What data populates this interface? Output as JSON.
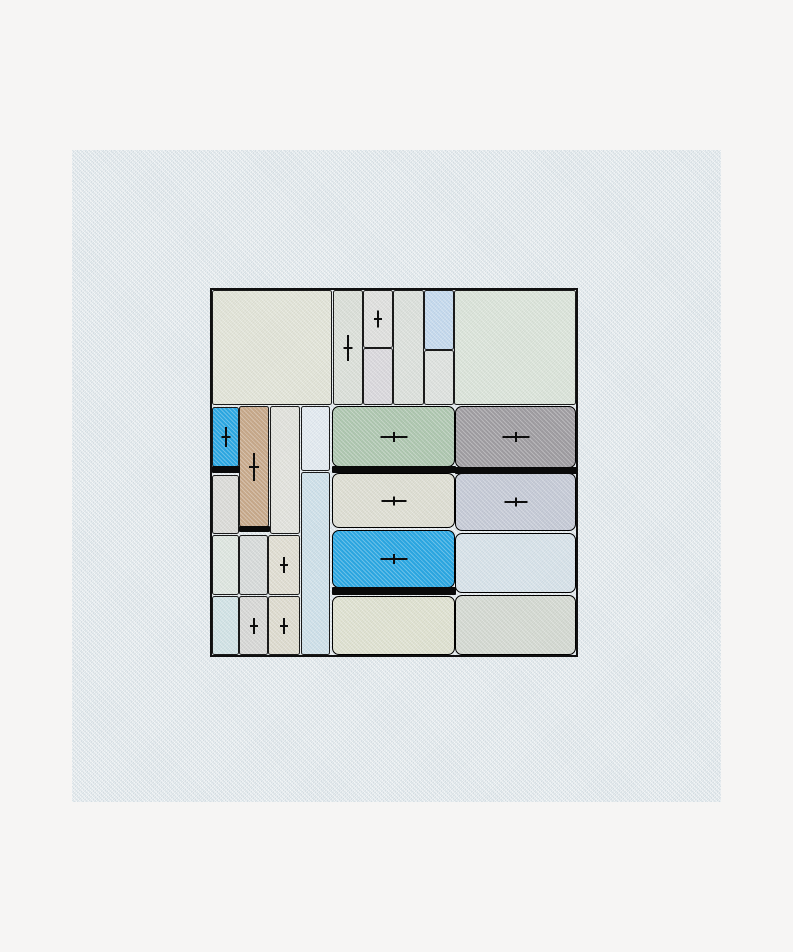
{
  "canvas": {
    "page_background": "#f6f5f4",
    "texture_region": {
      "x": 72,
      "y": 150,
      "w": 649,
      "h": 652,
      "color": "#e3e9ec"
    },
    "board": {
      "x": 212,
      "y": 290,
      "w": 364,
      "h": 365,
      "border_color": "#101010"
    },
    "accent_colors": {
      "bright_blue": "#29a8e4",
      "tan": "#c9a98a",
      "sage_green": "#afc8b0",
      "gray": "#a09da1",
      "selection_bar": "#0a0a0a"
    }
  },
  "cells": [
    {
      "id": "top-left-large",
      "x": 0,
      "y": 0,
      "w": 120,
      "h": 115,
      "color": "#e3e5d8"
    },
    {
      "id": "top-strip-1",
      "x": 121,
      "y": 0,
      "w": 30,
      "h": 115,
      "color": "#dce0d9",
      "plus": {
        "dir": "v",
        "len": 26,
        "cross": 9
      }
    },
    {
      "id": "top-strip-2-upper",
      "x": 151,
      "y": 0,
      "w": 30,
      "h": 58,
      "color": "#e0e0de",
      "plus": {
        "dir": "v",
        "len": 17,
        "cross": 8
      }
    },
    {
      "id": "top-strip-2-lower",
      "x": 151,
      "y": 58,
      "w": 30,
      "h": 57,
      "color": "#dbd9dd"
    },
    {
      "id": "top-strip-3",
      "x": 181,
      "y": 0,
      "w": 31,
      "h": 115,
      "color": "#dde1dc"
    },
    {
      "id": "top-strip-4-upper",
      "x": 212,
      "y": 0,
      "w": 30,
      "h": 60,
      "color": "#c5daee"
    },
    {
      "id": "top-strip-4-lower",
      "x": 212,
      "y": 60,
      "w": 30,
      "h": 55,
      "color": "#dfe2df"
    },
    {
      "id": "top-right-large",
      "x": 242,
      "y": 0,
      "w": 122,
      "h": 115,
      "color": "#dce5da"
    },
    {
      "id": "blue-small",
      "x": 0,
      "y": 117,
      "w": 27,
      "h": 60,
      "color": "#29a8e4",
      "bar": 7,
      "plus": {
        "dir": "v",
        "len": 20,
        "cross": 9
      }
    },
    {
      "id": "tan-tall",
      "x": 27,
      "y": 116,
      "w": 30,
      "h": 121,
      "color": "#c9a98a",
      "bar": 6,
      "plus": {
        "dir": "v",
        "len": 28,
        "cross": 10
      }
    },
    {
      "id": "left-strip-3",
      "x": 58,
      "y": 116,
      "w": 30,
      "h": 128,
      "color": "#e3e3dd"
    },
    {
      "id": "left-strip-4-upper",
      "x": 89,
      "y": 116,
      "w": 29,
      "h": 65,
      "color": "#e4ebf1"
    },
    {
      "id": "left-strip-4-lower",
      "x": 89,
      "y": 182,
      "w": 29,
      "h": 183,
      "color": "#cfe1ea"
    },
    {
      "id": "green-selected",
      "x": 120,
      "y": 116,
      "w": 123,
      "h": 61,
      "color": "#afc8b0",
      "rounded": true,
      "bar": 7,
      "plus": {
        "dir": "h",
        "len": 27,
        "cross": 10
      }
    },
    {
      "id": "gray-selected",
      "x": 243,
      "y": 116,
      "w": 121,
      "h": 62,
      "color": "#a09da1",
      "rounded": true,
      "bar": 7,
      "plus": {
        "dir": "h",
        "len": 27,
        "cross": 10
      }
    },
    {
      "id": "under-blue",
      "x": 0,
      "y": 185,
      "w": 27,
      "h": 59,
      "color": "#dcdcd8"
    },
    {
      "id": "mid-beige",
      "x": 120,
      "y": 183,
      "w": 123,
      "h": 55,
      "color": "#dfdfd3",
      "rounded": true,
      "plus": {
        "dir": "h",
        "len": 25,
        "cross": 9
      }
    },
    {
      "id": "lavender",
      "x": 243,
      "y": 183,
      "w": 121,
      "h": 58,
      "color": "#c6cbd7",
      "rounded": true,
      "plus": {
        "dir": "h",
        "len": 23,
        "cross": 9
      }
    },
    {
      "id": "row3-left-1",
      "x": 0,
      "y": 245,
      "w": 27,
      "h": 60,
      "color": "#dfe7e0"
    },
    {
      "id": "row3-left-2",
      "x": 27,
      "y": 245,
      "w": 29,
      "h": 60,
      "color": "#d8dbda"
    },
    {
      "id": "row3-left-3",
      "x": 56,
      "y": 245,
      "w": 32,
      "h": 60,
      "color": "#e1ded2",
      "plus": {
        "dir": "v",
        "len": 16,
        "cross": 8
      }
    },
    {
      "id": "blue-big-selected",
      "x": 120,
      "y": 240,
      "w": 123,
      "h": 58,
      "color": "#29a8e4",
      "rounded": true,
      "bar": 8,
      "plus": {
        "dir": "h",
        "len": 27,
        "cross": 10
      }
    },
    {
      "id": "right-lightblue",
      "x": 243,
      "y": 243,
      "w": 121,
      "h": 60,
      "color": "#d8e3ea",
      "rounded": true
    },
    {
      "id": "bottom-left-1",
      "x": 0,
      "y": 306,
      "w": 27,
      "h": 59,
      "color": "#d2e4e6"
    },
    {
      "id": "bottom-left-2",
      "x": 27,
      "y": 306,
      "w": 29,
      "h": 59,
      "color": "#d8d8d6",
      "plus": {
        "dir": "v",
        "len": 16,
        "cross": 8
      }
    },
    {
      "id": "bottom-left-3",
      "x": 56,
      "y": 306,
      "w": 32,
      "h": 59,
      "color": "#dfdccf",
      "plus": {
        "dir": "v",
        "len": 16,
        "cross": 8
      }
    },
    {
      "id": "bottom-mid",
      "x": 120,
      "y": 306,
      "w": 123,
      "h": 59,
      "color": "#e0e2d1",
      "rounded": true
    },
    {
      "id": "bottom-right",
      "x": 243,
      "y": 305,
      "w": 121,
      "h": 60,
      "color": "#d5dad2",
      "rounded": true
    }
  ]
}
